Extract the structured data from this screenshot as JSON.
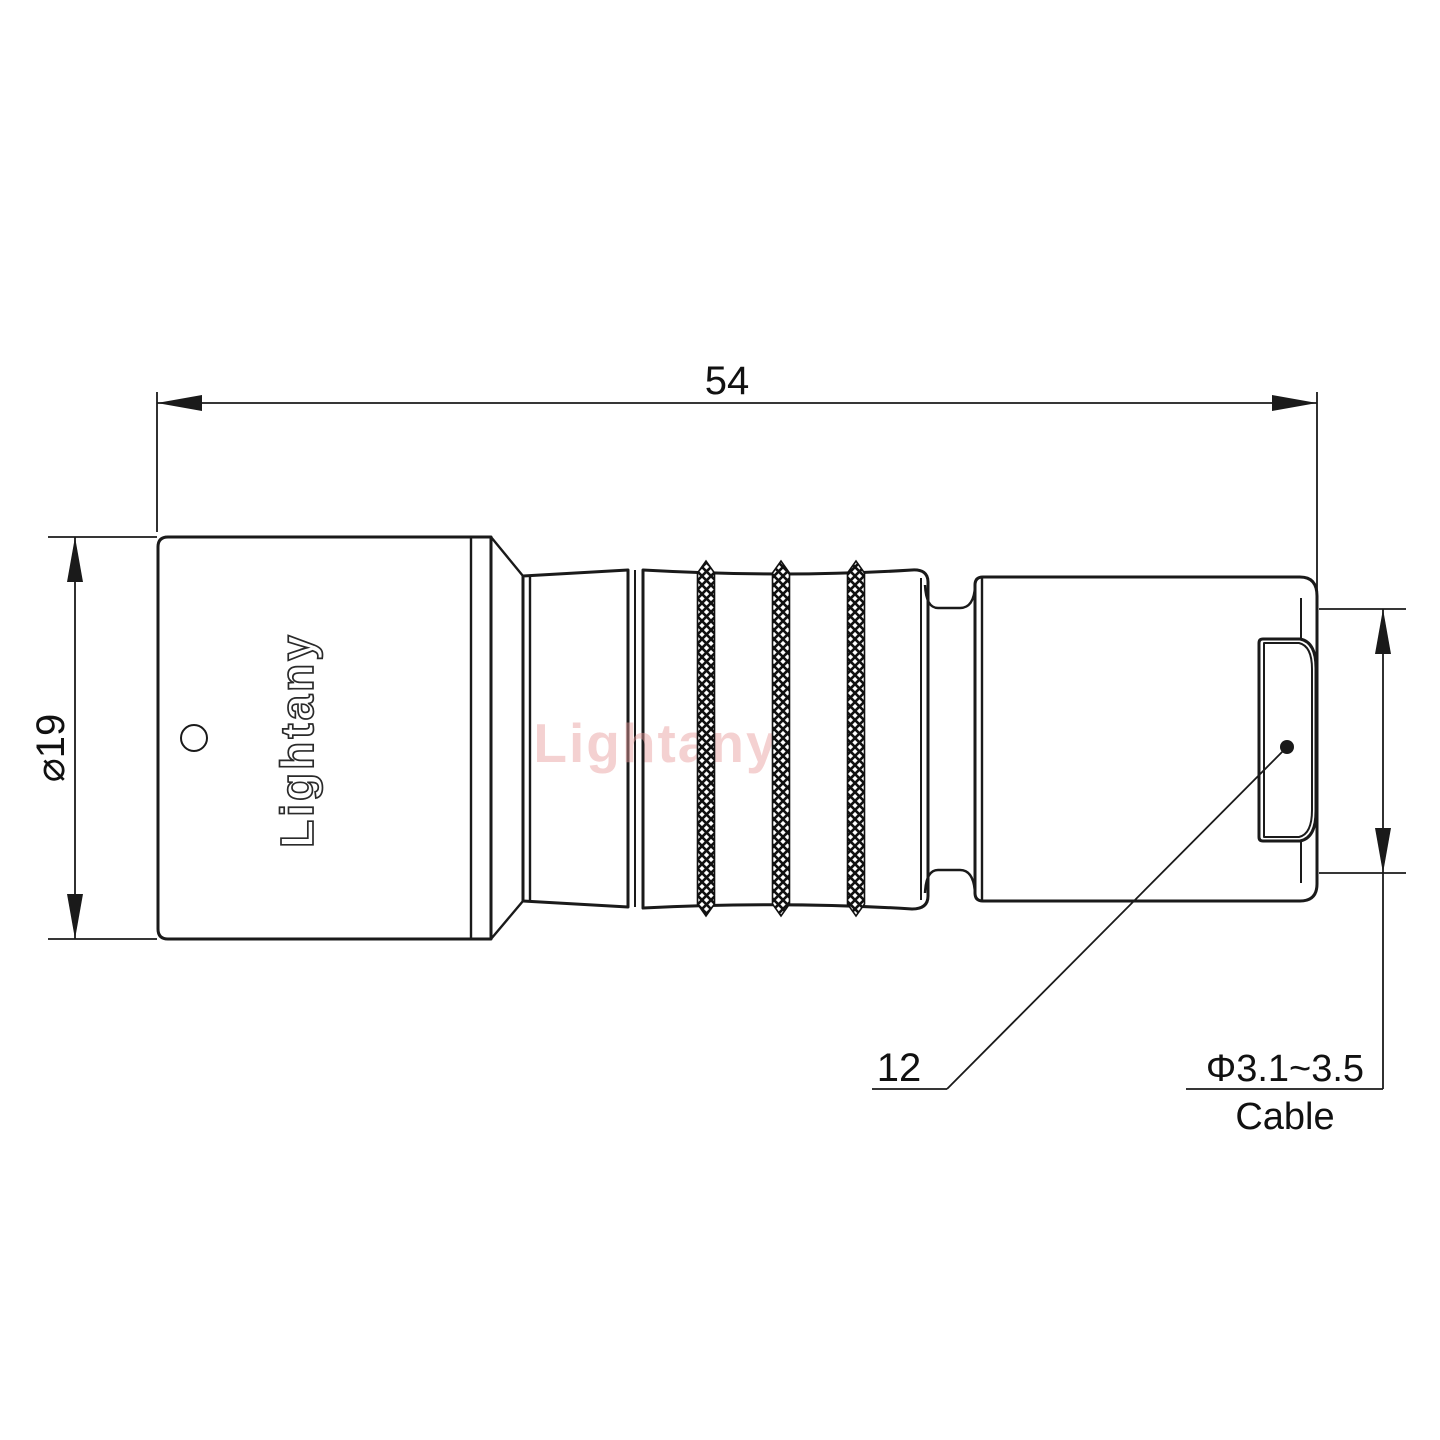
{
  "drawing": {
    "brand_engraving": "Lightany",
    "watermark": "Lightany",
    "watermark_color": "#e89b9b",
    "line_color": "#1a1a1a",
    "background": "#ffffff",
    "dims": {
      "overall_length": "54",
      "left_diameter": "⌀19",
      "leader_value": "12",
      "cable_diameter_range": "Φ3.1~3.5",
      "cable_word": "Cable"
    }
  }
}
